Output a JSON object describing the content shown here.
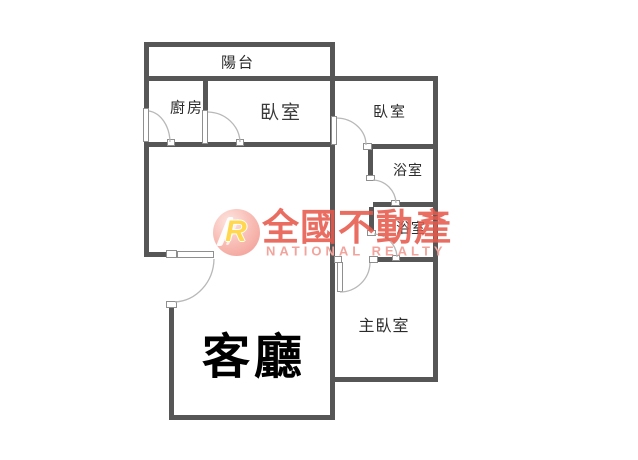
{
  "floor_plan": {
    "rooms": [
      {
        "id": "balcony",
        "label": "陽台"
      },
      {
        "id": "kitchen",
        "label": "廚房"
      },
      {
        "id": "bedroom-top",
        "label": "臥室"
      },
      {
        "id": "bedroom-right",
        "label": "臥室"
      },
      {
        "id": "bathroom-upper",
        "label": "浴室"
      },
      {
        "id": "bathroom-lower",
        "label": "浴室"
      },
      {
        "id": "master-bedroom",
        "label": "主臥室"
      },
      {
        "id": "living-room",
        "label": "客廳"
      }
    ]
  },
  "watermark": {
    "logo_letter": "R",
    "brand_name": "全國不動產",
    "brand_name_en": "NATIONAL REALTY",
    "brand_color": "#e85a4d",
    "brand_color_light": "#f2a49c",
    "logo_circle_color": "#f0938a",
    "logo_letter_color": "#ffd84f"
  },
  "colors": {
    "wall": "#565656",
    "door_arc": "#b8b8b8",
    "label_text": "#2b2b2b",
    "background": "#ffffff"
  }
}
